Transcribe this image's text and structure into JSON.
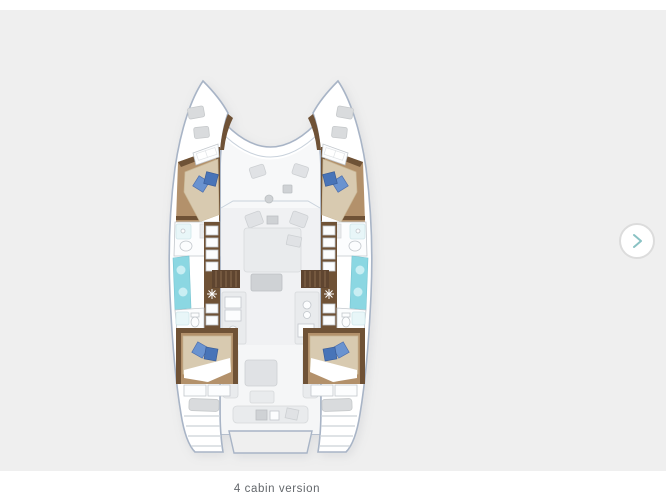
{
  "carousel": {
    "caption": "4 cabin version",
    "next_button_icon": "chevron-right"
  },
  "colors": {
    "page-bg": "#ffffff",
    "panel-bg": "#efefef",
    "hull-stroke": "#a8b4c6",
    "furniture": "#e0e2e5",
    "furniture-dark": "#cfd2d5",
    "wood": "#b3916b",
    "wood-dark": "#6f5236",
    "mattress": "#d8cab0",
    "cushion-blue": "#6a93d0",
    "cushion-blue-dark": "#4874b8",
    "window-cyan": "#8bd7e2",
    "window-cyan-light": "#c9eef3",
    "fixture-stroke": "#c2c7cc",
    "button-border": "#dcdcdc",
    "chevron": "#8ac2c4",
    "caption-text": "#63676b"
  }
}
